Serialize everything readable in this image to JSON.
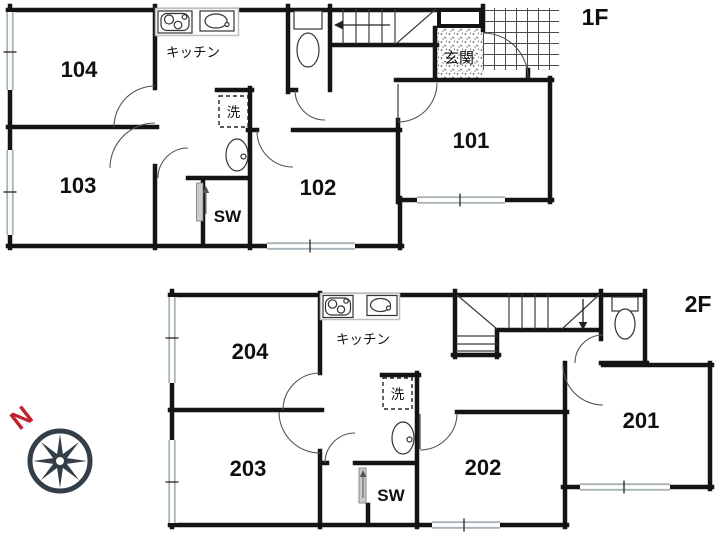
{
  "f1": {
    "label": "1F",
    "rooms": [
      "104",
      "103",
      "102",
      "101"
    ],
    "kitchen_label": "キッチン",
    "laundry_label": "洗",
    "closet_label": "SW",
    "entrance_label": "玄関"
  },
  "f2": {
    "label": "2F",
    "rooms": [
      "204",
      "203",
      "202",
      "201"
    ],
    "kitchen_label": "キッチン",
    "laundry_label": "洗",
    "closet_label": "SW"
  },
  "compass": {
    "north_label": "N"
  },
  "colors": {
    "wall": "#141414",
    "line": "#3c3c3c",
    "window": "#a9b4ba",
    "grid": "#4a4a4a",
    "compass": "#333e48",
    "north": "#c0222c",
    "panel": "#c8ccce"
  }
}
